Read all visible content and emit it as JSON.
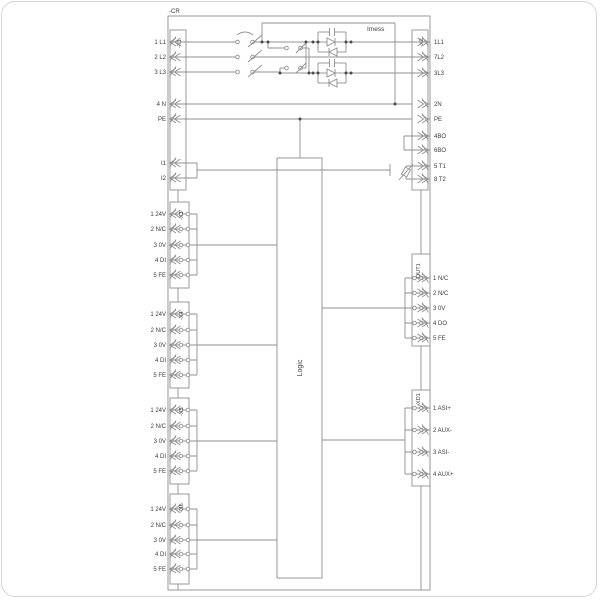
{
  "device": {
    "device_label": "-CR",
    "logic_label": "Logic",
    "imess_label": "Imess"
  },
  "x1": {
    "name": "-X1",
    "terminals": [
      "1 L1",
      "2 L2",
      "3 L3",
      "4 N",
      "PE",
      "I1",
      "I2"
    ]
  },
  "x2": {
    "name": "-X2",
    "terminals": [
      "1L1",
      "7L2",
      "3L3",
      "2N",
      "PE",
      "4BO",
      "6BO",
      "5 T1",
      "8 T2"
    ]
  },
  "left_groups": [
    {
      "name": "-X3",
      "terminals": [
        "1 24V",
        "2 N/C",
        "3 0V",
        "4 DI",
        "5 FE"
      ]
    },
    {
      "name": "-X4",
      "terminals": [
        "1 24V",
        "2 N/C",
        "3 0V",
        "4 DI",
        "5 FE"
      ]
    },
    {
      "name": "-X5",
      "terminals": [
        "1 24V",
        "2 N/C",
        "3 0V",
        "4 DI",
        "5 FE"
      ]
    },
    {
      "name": "-X6",
      "terminals": [
        "1 24V",
        "2 N/C",
        "3 0V",
        "4 DI",
        "5 FE"
      ]
    }
  ],
  "out1": {
    "name": "-OUT1",
    "terminals": [
      "1 N/C",
      "2 N/C",
      "3 0V",
      "4 DO",
      "5 FE"
    ]
  },
  "xd1": {
    "name": "-XD1",
    "terminals": [
      "1 ASI+",
      "2 AUX-",
      "3 ASI-",
      "4 AUX+"
    ]
  },
  "colors": {
    "line": "#909090",
    "text": "#3d3d3d",
    "frame": "#d6d6d6",
    "background": "#ffffff"
  }
}
